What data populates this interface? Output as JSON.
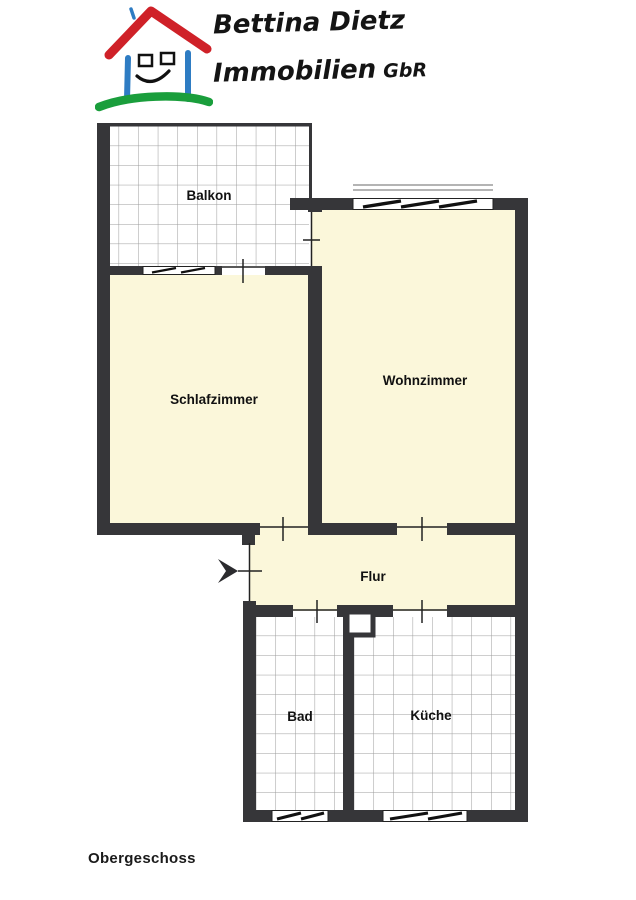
{
  "logo": {
    "line1": "Bettina Dietz",
    "line2": "Immobilien",
    "suffix": "GbR",
    "colors": {
      "roof": "#cf2128",
      "walls": "#2e7cc3",
      "ground": "#1a9e3c",
      "text": "#141414"
    }
  },
  "floorplan": {
    "caption": "Obergeschoss",
    "colors": {
      "wall": "#363639",
      "room_fill": "#fbf7da",
      "tile_line": "#9b9b9b"
    },
    "rooms": [
      {
        "id": "balkon",
        "label": "Balkon",
        "floor": "tile"
      },
      {
        "id": "schlafzimmer",
        "label": "Schlafzimmer",
        "floor": "cream"
      },
      {
        "id": "wohnzimmer",
        "label": "Wohnzimmer",
        "floor": "cream"
      },
      {
        "id": "flur",
        "label": "Flur",
        "floor": "cream"
      },
      {
        "id": "bad",
        "label": "Bad",
        "floor": "tile"
      },
      {
        "id": "kueche",
        "label": "Küche",
        "floor": "tile"
      }
    ],
    "entrance_arrow_direction": "right"
  }
}
